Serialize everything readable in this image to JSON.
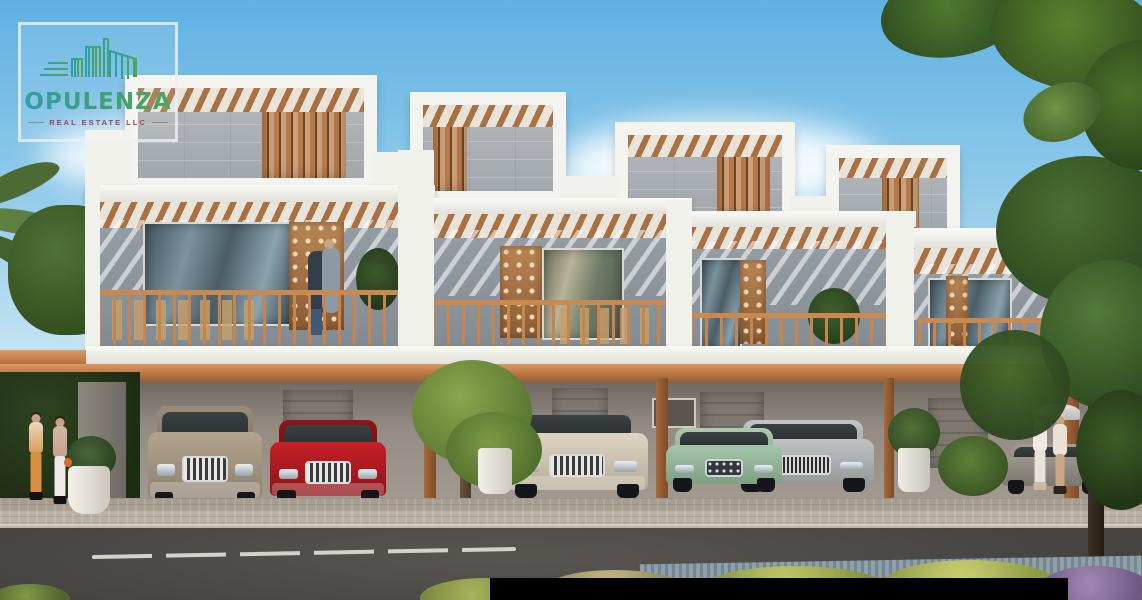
{
  "watermark": {
    "brand": "OPULENZA",
    "tagline": "REAL ESTATE LLC",
    "icon": "skyline-buildings-icon",
    "brand_gradient_start": "#2f9fa4",
    "brand_gradient_end": "#4fa45f",
    "tagline_color": "#a04553"
  },
  "scene": {
    "type": "architectural-rendering",
    "subject": "row of modern townhouses with wood-slat screens, balconies and covered parking, street in foreground",
    "palette": {
      "sky": "#5fb1e2",
      "facade_white": "#f3f3ef",
      "concrete_gray": "#aab0b5",
      "wood_accent": "#c07c49",
      "road": "#4b4947"
    },
    "cars": [
      {
        "name": "beige-suv",
        "color": "#a89a85"
      },
      {
        "name": "red-sedan",
        "color": "#b5201f"
      },
      {
        "name": "cream-suv",
        "color": "#d8d0bd"
      },
      {
        "name": "green-sedan",
        "color": "#9cbfa3"
      },
      {
        "name": "silver-sedan",
        "color": "#b6b9ba"
      },
      {
        "name": "gray-parked-car",
        "color": "#8f8a82"
      }
    ],
    "people": [
      {
        "name": "two-women-left-sidewalk"
      },
      {
        "name": "couple-on-balcony"
      },
      {
        "name": "two-visitors-right-with-umbrella"
      }
    ],
    "black_bar_color": "#000000"
  }
}
